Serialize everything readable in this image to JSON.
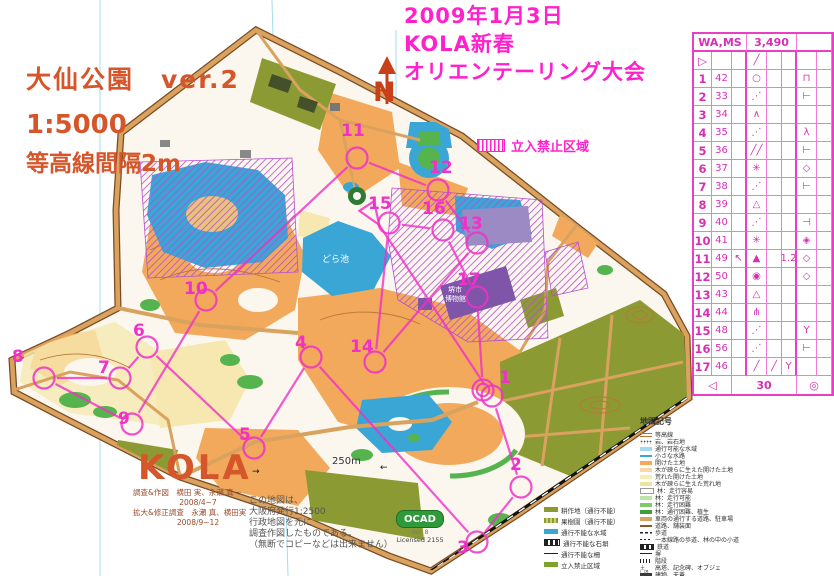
{
  "event": {
    "date_line": "2009年1月3日",
    "club_line": "KOLA新春",
    "event_line": "オリエンテーリング大会"
  },
  "map_title": {
    "name_line": "大仙公園　ver.2",
    "scale_line": "1:5000",
    "contour_line": "等高線間隔2m"
  },
  "north_arrow": {
    "label": "N"
  },
  "no_entry": {
    "label": "立入禁止区域"
  },
  "control_card": {
    "header": {
      "course_class": "WA,MS",
      "length": "3,490"
    },
    "start_row": {
      "a": "▷",
      "d": "╱"
    },
    "rows": [
      {
        "no": "1",
        "code": "42",
        "c": "",
        "d": "○",
        "e": "",
        "f": "",
        "g": "⊓",
        "h": ""
      },
      {
        "no": "2",
        "code": "33",
        "c": "",
        "d": "⋰",
        "e": "",
        "f": "",
        "g": "⊢",
        "h": ""
      },
      {
        "no": "3",
        "code": "34",
        "c": "",
        "d": "∧",
        "e": "",
        "f": "",
        "g": "",
        "h": ""
      },
      {
        "no": "4",
        "code": "35",
        "c": "",
        "d": "⋰",
        "e": "",
        "f": "",
        "g": "λ",
        "h": ""
      },
      {
        "no": "5",
        "code": "36",
        "c": "",
        "d": "╱╱",
        "e": "",
        "f": "",
        "g": "⊢",
        "h": ""
      },
      {
        "no": "6",
        "code": "37",
        "c": "",
        "d": "✳",
        "e": "",
        "f": "",
        "g": "◇",
        "h": ""
      },
      {
        "no": "7",
        "code": "38",
        "c": "",
        "d": "⋰",
        "e": "",
        "f": "",
        "g": "⊢",
        "h": ""
      },
      {
        "no": "8",
        "code": "39",
        "c": "",
        "d": "△",
        "e": "",
        "f": "",
        "g": "",
        "h": ""
      },
      {
        "no": "9",
        "code": "40",
        "c": "",
        "d": "⋰",
        "e": "",
        "f": "",
        "g": "⊣",
        "h": ""
      },
      {
        "no": "10",
        "code": "41",
        "c": "",
        "d": "✳",
        "e": "",
        "f": "",
        "g": "◈",
        "h": ""
      },
      {
        "no": "11",
        "code": "49",
        "c": "↖",
        "d": "▲",
        "e": "",
        "f": "1.2",
        "g": "◇",
        "h": ""
      },
      {
        "no": "12",
        "code": "50",
        "c": "",
        "d": "◉",
        "e": "",
        "f": "",
        "g": "◇",
        "h": ""
      },
      {
        "no": "13",
        "code": "43",
        "c": "",
        "d": "△",
        "e": "",
        "f": "",
        "g": "",
        "h": ""
      },
      {
        "no": "14",
        "code": "44",
        "c": "",
        "d": "⋔",
        "e": "",
        "f": "",
        "g": "",
        "h": ""
      },
      {
        "no": "15",
        "code": "48",
        "c": "",
        "d": "⋰",
        "e": "",
        "f": "",
        "g": "Y",
        "h": ""
      },
      {
        "no": "16",
        "code": "56",
        "c": "",
        "d": "⋰",
        "e": "",
        "f": "",
        "g": "⊢",
        "h": ""
      },
      {
        "no": "17",
        "code": "46",
        "c": "",
        "d": "╱",
        "e": "╱",
        "f": "Y",
        "g": "",
        "h": ""
      }
    ],
    "finish_row": {
      "left": "◁",
      "distance": "30",
      "right": "◎"
    }
  },
  "course": {
    "start": {
      "x": 372,
      "y": 214
    },
    "finish": {
      "x": 483,
      "y": 390
    },
    "controls": [
      {
        "n": "1",
        "cx": 492,
        "cy": 396,
        "lx": 499,
        "ly": 383
      },
      {
        "n": "2",
        "cx": 521,
        "cy": 487,
        "lx": 510,
        "ly": 470
      },
      {
        "n": "3",
        "cx": 477,
        "cy": 542,
        "lx": 457,
        "ly": 553
      },
      {
        "n": "4",
        "cx": 311,
        "cy": 357,
        "lx": 295,
        "ly": 348
      },
      {
        "n": "5",
        "cx": 254,
        "cy": 448,
        "lx": 239,
        "ly": 440
      },
      {
        "n": "6",
        "cx": 147,
        "cy": 347,
        "lx": 133,
        "ly": 336
      },
      {
        "n": "7",
        "cx": 120,
        "cy": 378,
        "lx": 98,
        "ly": 373
      },
      {
        "n": "8",
        "cx": 44,
        "cy": 378,
        "lx": 12,
        "ly": 362
      },
      {
        "n": "9",
        "cx": 132,
        "cy": 424,
        "lx": 118,
        "ly": 424
      },
      {
        "n": "10",
        "cx": 206,
        "cy": 300,
        "lx": 184,
        "ly": 294
      },
      {
        "n": "11",
        "cx": 357,
        "cy": 158,
        "lx": 341,
        "ly": 136
      },
      {
        "n": "12",
        "cx": 438,
        "cy": 190,
        "lx": 429,
        "ly": 173
      },
      {
        "n": "13",
        "cx": 477,
        "cy": 243,
        "lx": 459,
        "ly": 229
      },
      {
        "n": "14",
        "cx": 375,
        "cy": 362,
        "lx": 350,
        "ly": 352
      },
      {
        "n": "15",
        "cx": 389,
        "cy": 223,
        "lx": 368,
        "ly": 209
      },
      {
        "n": "16",
        "cx": 443,
        "cy": 230,
        "lx": 422,
        "ly": 214
      },
      {
        "n": "17",
        "cx": 477,
        "cy": 297,
        "lx": 457,
        "ly": 285
      }
    ]
  },
  "map_labels": {
    "pond": "どら池",
    "museum1": "堺市",
    "museum2": "博物館",
    "arrow_right": "→",
    "arrow_left": "←"
  },
  "scale_bar": {
    "label": "250m"
  },
  "kola": {
    "logo": "KOLA",
    "credits": [
      "調査&作図　横田 実、永瀬 真一",
      "2008/4~7",
      "拡大&修正調査　永瀬 真、横田実",
      "2008/9~12"
    ]
  },
  "note": {
    "lines": [
      "この地図は、",
      "大阪府発行1:2500",
      "行政地図を元に",
      "調査作図したものである。",
      "（無断でコピーなどは出来ません）"
    ]
  },
  "ocad": {
    "name": "OCAD",
    "version": "Ver. 8",
    "license": "Licensed 2155"
  },
  "legend_left": {
    "items": [
      {
        "label": "耕作地（通行不能）",
        "sw": "olive"
      },
      {
        "label": "果樹園（通行不能）",
        "sw": "olive2"
      },
      {
        "label": "通行不能な水域",
        "sw": "blue"
      },
      {
        "label": "通行不能な石塀",
        "sw": "rail"
      },
      {
        "label": "通行不能な柵",
        "sw": "fence"
      },
      {
        "label": "立入禁止区域",
        "sw": "olivegreen"
      }
    ]
  },
  "legend_right": {
    "title": "地図記号",
    "items": [
      {
        "label": "等高線",
        "sw": "contour"
      },
      {
        "label": "岩、岩石地",
        "sw": "dots"
      },
      {
        "label": "通行可能な水域",
        "sw": "lightblue"
      },
      {
        "label": "小さな水路",
        "sw": "blueline"
      },
      {
        "label": "開けた土地",
        "sw": "orange"
      },
      {
        "label": "木が疎らに生えた開けた土地",
        "sw": "paleorange"
      },
      {
        "label": "荒れた開けた土地",
        "sw": "paleyellow"
      },
      {
        "label": "木が疎らに生えた荒れ地",
        "sw": "paleyellow2"
      },
      {
        "label": "林：走行容易",
        "sw": "white"
      },
      {
        "label": "林：走行可能",
        "sw": "lightgreen"
      },
      {
        "label": "林：走行困難",
        "sw": "green"
      },
      {
        "label": "林：通行困難、植生",
        "sw": "darkgreen"
      },
      {
        "label": "車両の通行する道路、駐車場",
        "sw": "tan"
      },
      {
        "label": "道路、舗装面",
        "sw": "tanline"
      },
      {
        "label": "歩道",
        "sw": "dash"
      },
      {
        "label": "一本線路の歩道、林の中の小道",
        "sw": "dashthin"
      },
      {
        "label": "鉄道",
        "sw": "rail"
      },
      {
        "label": "塀",
        "sw": "wall"
      },
      {
        "label": "階段",
        "sw": "steps"
      },
      {
        "label": "高塔、記念碑、オブジェ",
        "sw": "symbols",
        "prefix": "＋□×"
      },
      {
        "label": "建物、天蓋",
        "sw": "building"
      }
    ]
  },
  "colors": {
    "course": "#F030C8",
    "title_magenta": "#FF22CC",
    "title_orange": "#D4562A",
    "olive": "#8C9A33",
    "open_orange": "#F2A95B",
    "pond_blue": "#3AA6D6",
    "purple_hatch": "#B44FD0",
    "road_tan": "#D9A25F"
  }
}
